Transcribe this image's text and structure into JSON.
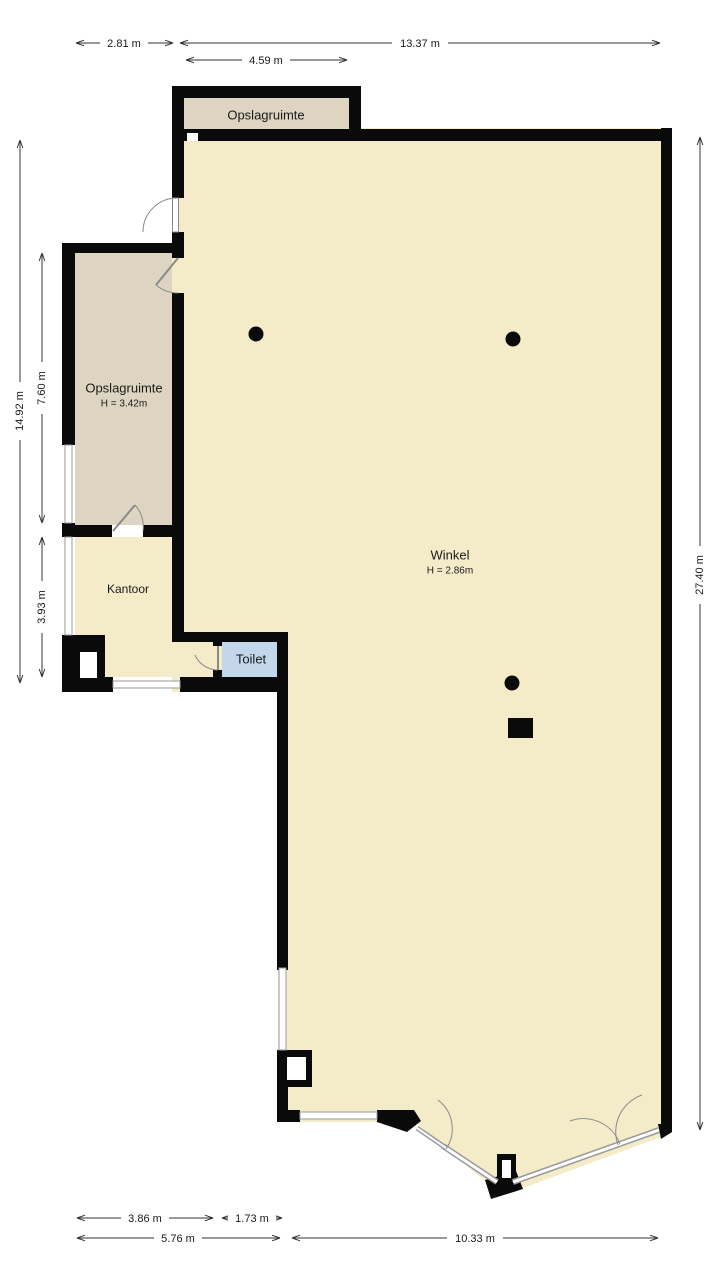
{
  "plan": {
    "type": "floorplan",
    "colors": {
      "wall": "#0a0a0a",
      "winkel_floor": "#f4ebc9",
      "storage_floor": "#ddd5c1",
      "toilet_floor": "#c2d7e9",
      "window_line": "#9a9a9a",
      "dimension_line": "#333333",
      "background": "#ffffff"
    },
    "rooms": {
      "storage_top": {
        "name": "Opslagruimte"
      },
      "storage_left": {
        "name": "Opslagruimte",
        "height": "H = 3.42m"
      },
      "kantoor": {
        "name": "Kantoor"
      },
      "toilet": {
        "name": "Toilet"
      },
      "winkel": {
        "name": "Winkel",
        "height": "H = 2.86m"
      }
    },
    "dimensions": {
      "top_row1_left": "2.81 m",
      "top_row1_right": "13.37 m",
      "top_row2": "4.59 m",
      "left_outer": "14.92 m",
      "left_storage": "7.60 m",
      "left_kantoor": "3.93 m",
      "right_outer": "27.40 m",
      "bottom_row1_left": "3.86 m",
      "bottom_row1_right": "1.73 m",
      "bottom_row2_left": "5.76 m",
      "bottom_row2_right": "10.33 m"
    }
  }
}
